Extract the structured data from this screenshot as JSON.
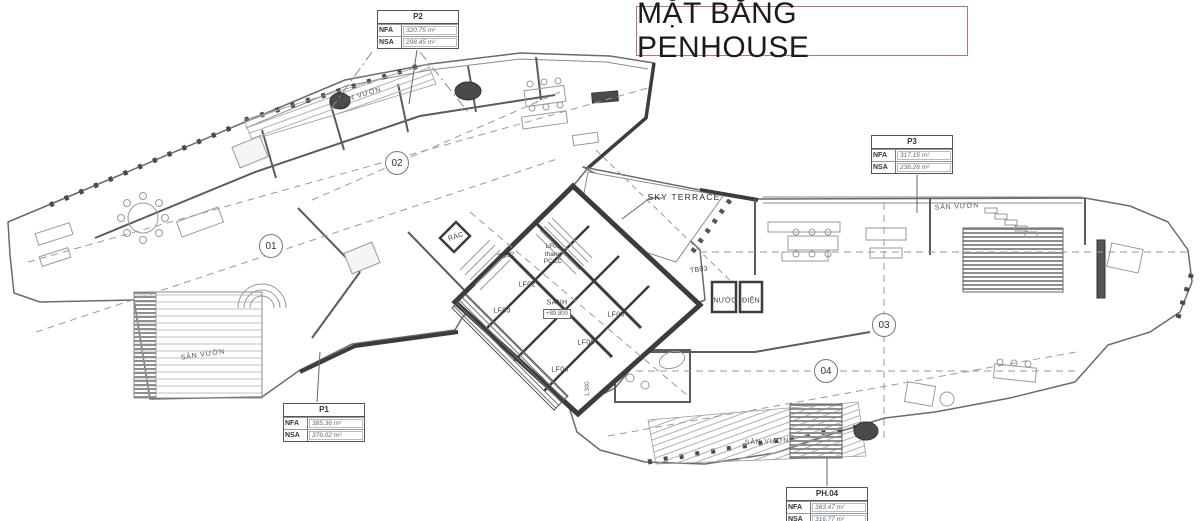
{
  "title": "MẶT BẰNG PENHOUSE",
  "field_labels": {
    "nfa": "NFA",
    "nsa": "NSA"
  },
  "units": {
    "p1": {
      "name": "P1",
      "nfa": "385.36 m²",
      "nsa": "376.02 m²"
    },
    "p2": {
      "name": "P2",
      "nfa": "320.75 m²",
      "nsa": "298.45 m²"
    },
    "p3": {
      "name": "P3",
      "nfa": "317.15 m²",
      "nsa": "236.26 m²"
    },
    "ph04": {
      "name": "PH.04",
      "nfa": "363.47 m²",
      "nsa": "316.77 m²"
    }
  },
  "grid_markers": {
    "m01": "01",
    "m02": "02",
    "m03": "03",
    "m04": "04"
  },
  "rooms": {
    "sky_terrace": "SKY TERRACE",
    "garden": "SÂN VƯỜN",
    "lobby": "SẢNH",
    "lobby_elevation": "+89.800",
    "lf01": "LF01",
    "lf01_sub1": "thang",
    "lf01_sub2": "PCCC",
    "lf02": "LF02",
    "lf03": "LF03",
    "lf04": "LF04",
    "lf05": "LF05",
    "lf06": "LF06",
    "tb02": "TB02",
    "tb03": "TB03",
    "trash": "RÁC",
    "water": "NƯỚC",
    "electric": "ĐIỆN"
  },
  "dimensions": {
    "d1": "1.300"
  },
  "colors": {
    "title_border": "#c0706e",
    "wall": "#3c3c3c",
    "line": "#7a7a7a"
  }
}
